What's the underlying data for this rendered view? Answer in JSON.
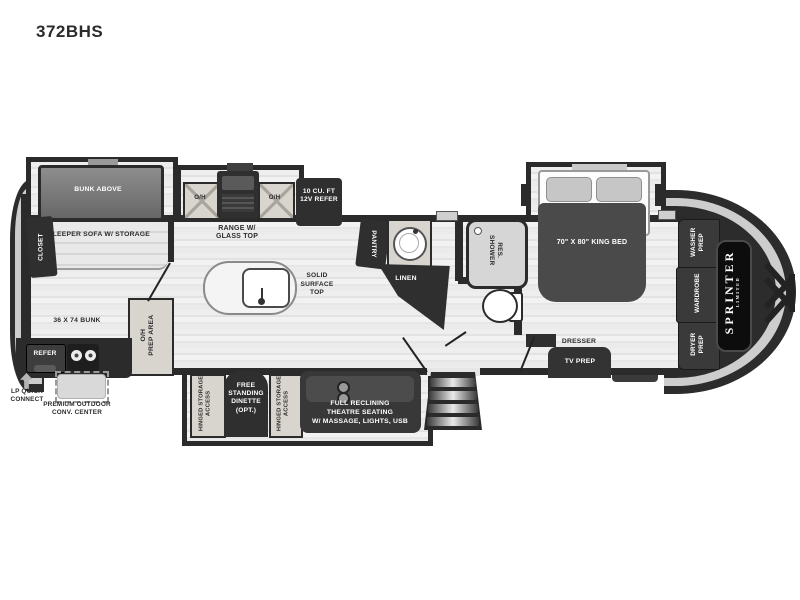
{
  "title": "372BHS",
  "colors": {
    "wall": "#2b2b2b",
    "furniture_dark": "#2f2f2f",
    "cabinet_tan": "#d8d5cf",
    "floor_light": "#ebebeb",
    "cap_band": "#cdcdcd",
    "brand_panel": "#0d0d0d"
  },
  "labels": {
    "closet": "CLOSET",
    "bunk_above": "BUNK ABOVE",
    "sleeper_sofa": "SLEEPER SOFA W/ STORAGE",
    "bunk": "36 X 74 BUNK",
    "refer": "REFER",
    "lp1": "LP QUICK",
    "lp2": "CONNECT",
    "outdoor1": "PREMIUM OUTDOOR",
    "outdoor2": "CONV. CENTER",
    "oh": "O/H",
    "prep_area": "PREP AREA",
    "range1": "RANGE W/",
    "range2": "GLASS TOP",
    "refer12v_1": "10 CU. FT",
    "refer12v_2": "12V REFER",
    "island1": "SOLID",
    "island2": "SURFACE",
    "island3": "TOP",
    "pantry": "PANTRY",
    "linen": "LINEN",
    "shower1": "RES.",
    "shower2": "SHOWER",
    "king_bed": "70\" X 80\" KING BED",
    "dresser": "DRESSER",
    "tv_prep": "TV PREP",
    "washer1": "WASHER",
    "washer2": "PREP",
    "wardrobe": "WARDROBE",
    "dryer1": "DRYER",
    "dryer2": "PREP",
    "brand": "SPRINTER",
    "brand_sub": "LIMITED",
    "hinged1": "HINGED STORAGE",
    "hinged2": "ACCESS",
    "dinette1": "FREE",
    "dinette2": "STANDING",
    "dinette3": "DINETTE",
    "dinette4": "(OPT.)",
    "theatre1": "FULL RECLINING",
    "theatre2": "THEATRE SEATING",
    "theatre3": "W/ MASSAGE, LIGHTS, USB"
  }
}
